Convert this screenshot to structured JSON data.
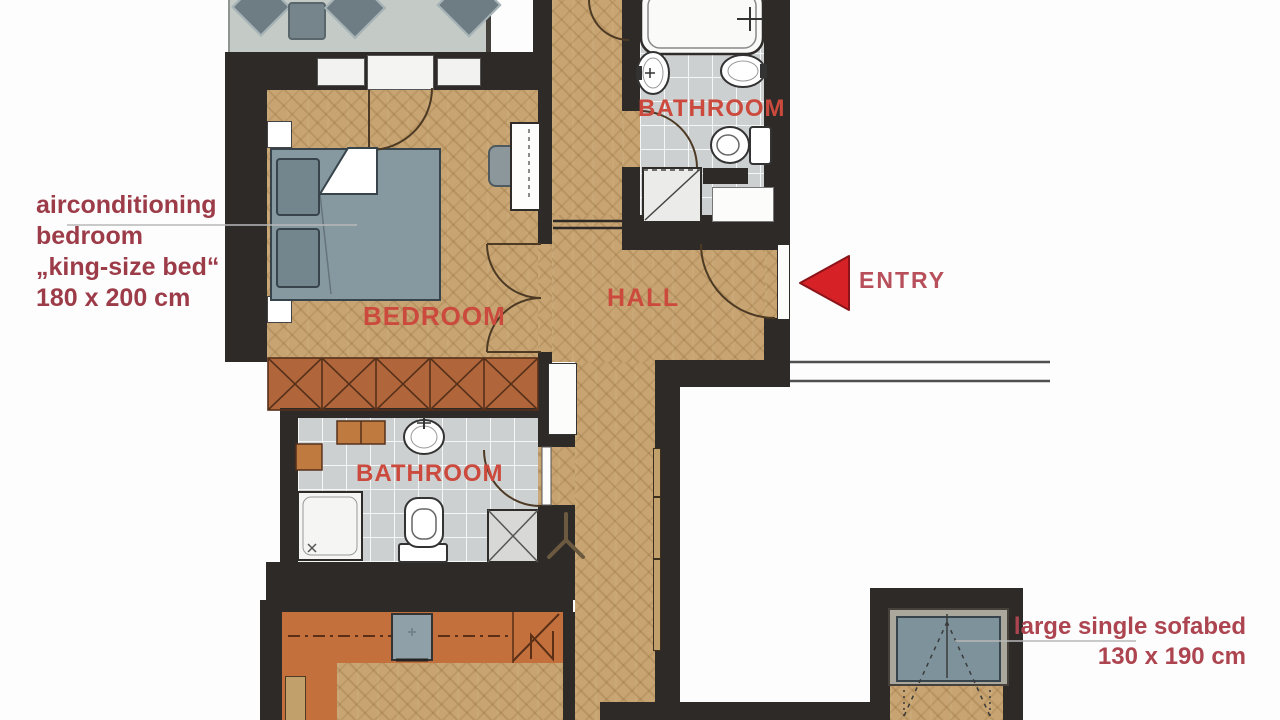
{
  "rooms": {
    "bedroom_label": "BEDROOM",
    "bathroom_top_label": "BATHROOM",
    "bathroom_middle_label": "BATHROOM",
    "hall_label": "HALL"
  },
  "entry": {
    "label": "ENTRY"
  },
  "annotations": {
    "bedroom_note": {
      "lines": [
        "airconditioning",
        "bedroom",
        "„king-size bed“",
        "180 x 200 cm"
      ]
    },
    "sofabed_note": {
      "lines": [
        "large single sofabed",
        "130 x 190 cm"
      ]
    }
  },
  "colors": {
    "wall": "#2e2a27",
    "wood_floor": "#c7a471",
    "tile_floor": "#cdd0d1",
    "terrace_floor": "#c4cbc7",
    "kitchen_counter": "#c3703d",
    "wardrobe": "#b0663a",
    "furniture_gray": "#7e929b",
    "room_label_red": "#cc4a3d",
    "note_red": "#9d3c49",
    "sofabed_note_red": "#ad4550",
    "entry_label_red": "#b8505b",
    "entry_arrow_red": "#d62127"
  }
}
